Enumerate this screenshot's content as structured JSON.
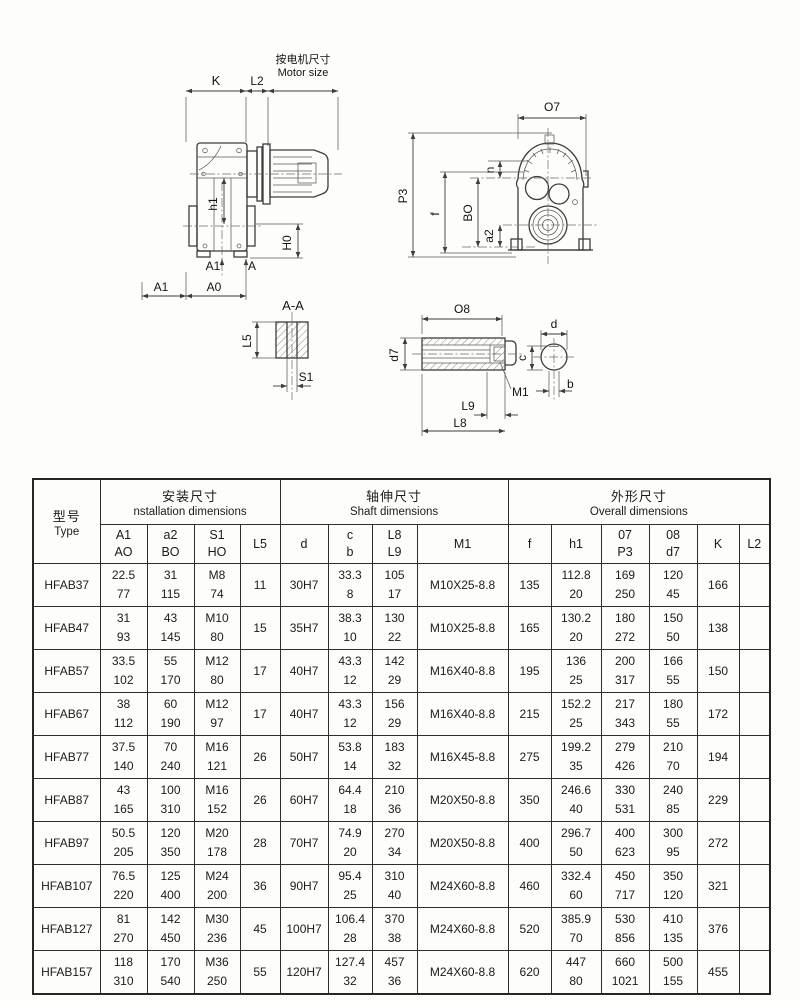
{
  "drawings": {
    "side_view": {
      "k": "K",
      "l2": "L2",
      "motor_size_cn": "按电机尺寸",
      "motor_size_en": "Motor size",
      "h1": "h1",
      "h0": "H0",
      "a1_inner": "A1",
      "a_inner": "A",
      "a1_outer": "A1",
      "a0_outer": "A0"
    },
    "front_view": {
      "o7": "O7",
      "p3": "P3",
      "f": "f",
      "bo": "BO",
      "a2": "a2",
      "n": "n"
    },
    "section_view": {
      "title": "A-A",
      "l5": "L5",
      "s1": "S1"
    },
    "shaft_view": {
      "o8": "O8",
      "d7": "d7",
      "m1": "M1",
      "l9": "L9",
      "l8": "L8",
      "d": "d",
      "c": "c",
      "b": "b"
    }
  },
  "table": {
    "type_header": {
      "cn": "型号",
      "en": "Type"
    },
    "groups": [
      {
        "cn": "安装尺寸",
        "en": "nstallation dimensions"
      },
      {
        "cn": "轴伸尺寸",
        "en": "Shaft dimensions"
      },
      {
        "cn": "外形尺寸",
        "en": "Overall dimensions"
      }
    ],
    "columns": [
      {
        "top": "A1",
        "bottom": "AO"
      },
      {
        "top": "a2",
        "bottom": "BO"
      },
      {
        "top": "S1",
        "bottom": "HO"
      },
      {
        "top": "L5"
      },
      {
        "top": "d"
      },
      {
        "top": "c",
        "bottom": "b"
      },
      {
        "top": "L8",
        "bottom": "L9"
      },
      {
        "top": "M1"
      },
      {
        "top": "f"
      },
      {
        "top": "h1"
      },
      {
        "top": "07",
        "bottom": "P3"
      },
      {
        "top": "08",
        "bottom": "d7"
      },
      {
        "top": "K"
      },
      {
        "top": "L2"
      }
    ],
    "rows": [
      {
        "type": "HFAB37",
        "a1_ao": [
          "22.5",
          "77"
        ],
        "a2_bo": [
          "31",
          "115"
        ],
        "s1_ho": [
          "M8",
          "74"
        ],
        "l5": "11",
        "d": "30H7",
        "c_b": [
          "33.3",
          "8"
        ],
        "l8_l9": [
          "105",
          "17"
        ],
        "m1": "M10X25-8.8",
        "f": "135",
        "h1": [
          "112.8",
          "20"
        ],
        "o7_p3": [
          "169",
          "250"
        ],
        "o8_d7": [
          "120",
          "45"
        ],
        "k": "166",
        "l2": ""
      },
      {
        "type": "HFAB47",
        "a1_ao": [
          "31",
          "93"
        ],
        "a2_bo": [
          "43",
          "145"
        ],
        "s1_ho": [
          "M10",
          "80"
        ],
        "l5": "15",
        "d": "35H7",
        "c_b": [
          "38.3",
          "10"
        ],
        "l8_l9": [
          "130",
          "22"
        ],
        "m1": "M10X25-8.8",
        "f": "165",
        "h1": [
          "130.2",
          "20"
        ],
        "o7_p3": [
          "180",
          "272"
        ],
        "o8_d7": [
          "150",
          "50"
        ],
        "k": "138",
        "l2": ""
      },
      {
        "type": "HFAB57",
        "a1_ao": [
          "33.5",
          "102"
        ],
        "a2_bo": [
          "55",
          "170"
        ],
        "s1_ho": [
          "M12",
          "80"
        ],
        "l5": "17",
        "d": "40H7",
        "c_b": [
          "43.3",
          "12"
        ],
        "l8_l9": [
          "142",
          "29"
        ],
        "m1": "M16X40-8.8",
        "f": "195",
        "h1": [
          "136",
          "25"
        ],
        "o7_p3": [
          "200",
          "317"
        ],
        "o8_d7": [
          "166",
          "55"
        ],
        "k": "150",
        "l2": ""
      },
      {
        "type": "HFAB67",
        "a1_ao": [
          "38",
          "112"
        ],
        "a2_bo": [
          "60",
          "190"
        ],
        "s1_ho": [
          "M12",
          "97"
        ],
        "l5": "17",
        "d": "40H7",
        "c_b": [
          "43.3",
          "12"
        ],
        "l8_l9": [
          "156",
          "29"
        ],
        "m1": "M16X40-8.8",
        "f": "215",
        "h1": [
          "152.2",
          "25"
        ],
        "o7_p3": [
          "217",
          "343"
        ],
        "o8_d7": [
          "180",
          "55"
        ],
        "k": "172",
        "l2": ""
      },
      {
        "type": "HFAB77",
        "a1_ao": [
          "37.5",
          "140"
        ],
        "a2_bo": [
          "70",
          "240"
        ],
        "s1_ho": [
          "M16",
          "121"
        ],
        "l5": "26",
        "d": "50H7",
        "c_b": [
          "53.8",
          "14"
        ],
        "l8_l9": [
          "183",
          "32"
        ],
        "m1": "M16X45-8.8",
        "f": "275",
        "h1": [
          "199.2",
          "35"
        ],
        "o7_p3": [
          "279",
          "426"
        ],
        "o8_d7": [
          "210",
          "70"
        ],
        "k": "194",
        "l2": ""
      },
      {
        "type": "HFAB87",
        "a1_ao": [
          "43",
          "165"
        ],
        "a2_bo": [
          "100",
          "310"
        ],
        "s1_ho": [
          "M16",
          "152"
        ],
        "l5": "26",
        "d": "60H7",
        "c_b": [
          "64.4",
          "18"
        ],
        "l8_l9": [
          "210",
          "36"
        ],
        "m1": "M20X50-8.8",
        "f": "350",
        "h1": [
          "246.6",
          "40"
        ],
        "o7_p3": [
          "330",
          "531"
        ],
        "o8_d7": [
          "240",
          "85"
        ],
        "k": "229",
        "l2": ""
      },
      {
        "type": "HFAB97",
        "a1_ao": [
          "50.5",
          "205"
        ],
        "a2_bo": [
          "120",
          "350"
        ],
        "s1_ho": [
          "M20",
          "178"
        ],
        "l5": "28",
        "d": "70H7",
        "c_b": [
          "74.9",
          "20"
        ],
        "l8_l9": [
          "270",
          "34"
        ],
        "m1": "M20X50-8.8",
        "f": "400",
        "h1": [
          "296.7",
          "50"
        ],
        "o7_p3": [
          "400",
          "623"
        ],
        "o8_d7": [
          "300",
          "95"
        ],
        "k": "272",
        "l2": ""
      },
      {
        "type": "HFAB107",
        "a1_ao": [
          "76.5",
          "220"
        ],
        "a2_bo": [
          "125",
          "400"
        ],
        "s1_ho": [
          "M24",
          "200"
        ],
        "l5": "36",
        "d": "90H7",
        "c_b": [
          "95.4",
          "25"
        ],
        "l8_l9": [
          "310",
          "40"
        ],
        "m1": "M24X60-8.8",
        "f": "460",
        "h1": [
          "332.4",
          "60"
        ],
        "o7_p3": [
          "450",
          "717"
        ],
        "o8_d7": [
          "350",
          "120"
        ],
        "k": "321",
        "l2": ""
      },
      {
        "type": "HFAB127",
        "a1_ao": [
          "81",
          "270"
        ],
        "a2_bo": [
          "142",
          "450"
        ],
        "s1_ho": [
          "M30",
          "236"
        ],
        "l5": "45",
        "d": "100H7",
        "c_b": [
          "106.4",
          "28"
        ],
        "l8_l9": [
          "370",
          "38"
        ],
        "m1": "M24X60-8.8",
        "f": "520",
        "h1": [
          "385.9",
          "70"
        ],
        "o7_p3": [
          "530",
          "856"
        ],
        "o8_d7": [
          "410",
          "135"
        ],
        "k": "376",
        "l2": ""
      },
      {
        "type": "HFAB157",
        "a1_ao": [
          "118",
          "310"
        ],
        "a2_bo": [
          "170",
          "540"
        ],
        "s1_ho": [
          "M36",
          "250"
        ],
        "l5": "55",
        "d": "120H7",
        "c_b": [
          "127.4",
          "32"
        ],
        "l8_l9": [
          "457",
          "36"
        ],
        "m1": "M24X60-8.8",
        "f": "620",
        "h1": [
          "447",
          "80"
        ],
        "o7_p3": [
          "660",
          "1021"
        ],
        "o8_d7": [
          "500",
          "155"
        ],
        "k": "455",
        "l2": ""
      }
    ]
  }
}
